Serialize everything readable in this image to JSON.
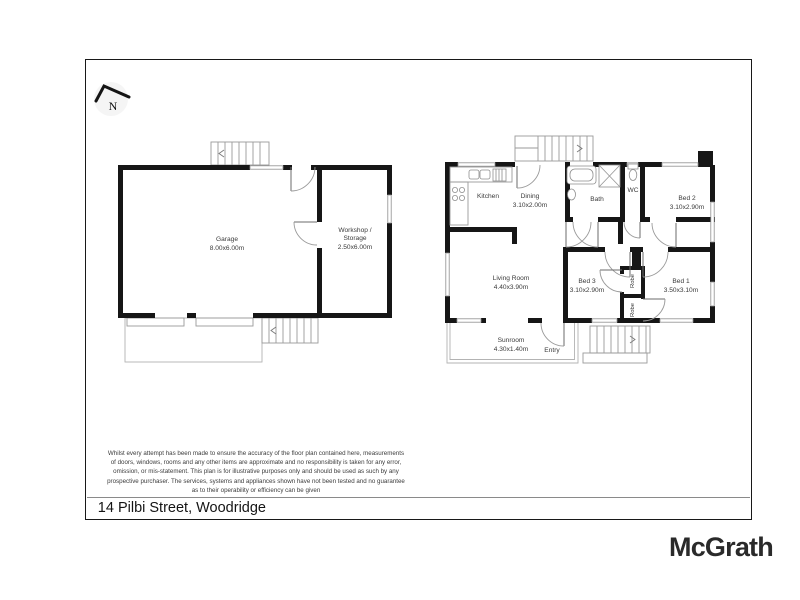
{
  "document": {
    "compass": "N",
    "address": "14 Pilbi Street, Woodridge",
    "brand": "McGrath",
    "disclaimer": [
      "Whilst every attempt has been made to ensure the accuracy of the floor plan contained here, measurements",
      "of doors, windows, rooms and any other items are approximate and no responsibility is taken for any error,",
      "omission, or mis-statement. This plan is for illustrative purposes only and should be used as such by any",
      "prospective purchaser. The services, systems and appliances shown have not been tested and no guarantee",
      "as to their operability or efficiency can be given"
    ]
  },
  "rooms": {
    "garage": {
      "name": "Garage",
      "dims": "8.00x6.00m"
    },
    "workshop": {
      "name": "Workshop /",
      "name2": "Storage",
      "dims": "2.50x6.00m"
    },
    "kitchen": {
      "name": "Kitchen"
    },
    "dining": {
      "name": "Dining",
      "dims": "3.10x2.00m"
    },
    "bath": {
      "name": "Bath"
    },
    "wc": {
      "name": "WC"
    },
    "bed2": {
      "name": "Bed 2",
      "dims": "3.10x2.90m"
    },
    "living": {
      "name": "Living Room",
      "dims": "4.40x3.90m"
    },
    "bed3": {
      "name": "Bed 3",
      "dims": "3.10x2.90m"
    },
    "bed1": {
      "name": "Bed 1",
      "dims": "3.50x3.10m"
    },
    "robe_upper": {
      "name": "Robe"
    },
    "robe_lower": {
      "name": "Robe"
    },
    "sunroom": {
      "name": "Sunroom",
      "dims": "4.30x1.40m"
    },
    "entry": {
      "name": "Entry"
    }
  },
  "colors": {
    "wall": "#161616",
    "thin_line": "#9a9a9a",
    "label": "#3a3a3a",
    "brand": "#2a2a2a"
  }
}
